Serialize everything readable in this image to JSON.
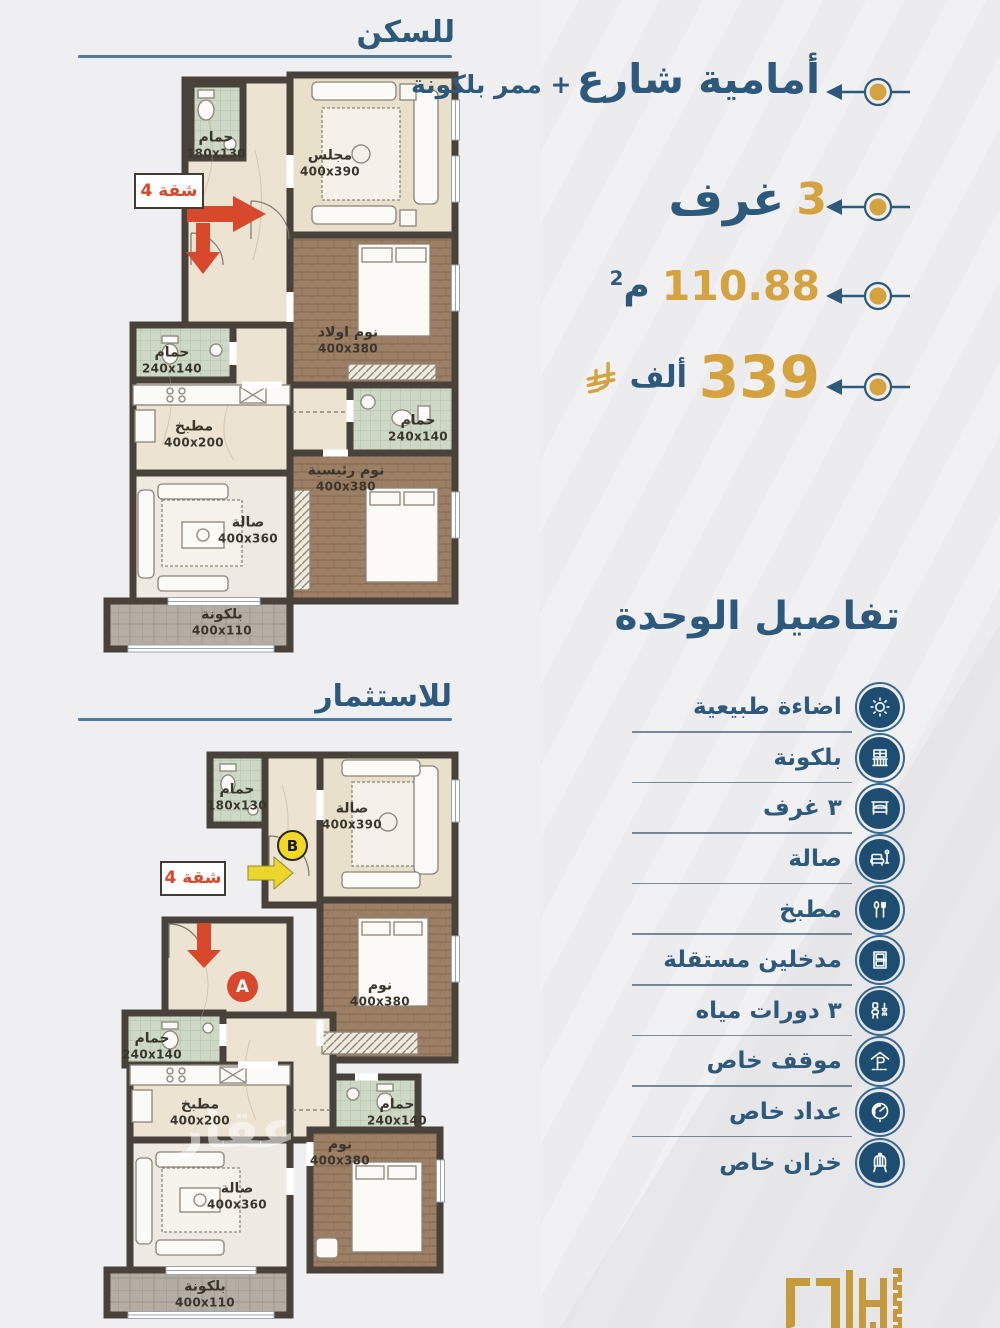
{
  "plans": {
    "residence": {
      "title": "للسكن",
      "badge": "شقة 4",
      "rooms": {
        "bath1": {
          "name": "حمام",
          "dims": "180x130"
        },
        "majlis": {
          "name": "مجلس",
          "dims": "400x390"
        },
        "kids_bedroom": {
          "name": "نوم اولاد",
          "dims": "400x380"
        },
        "bath2": {
          "name": "حمام",
          "dims": "240x140"
        },
        "kitchen": {
          "name": "مطبخ",
          "dims": "400x200"
        },
        "bath3": {
          "name": "حمام",
          "dims": "240x140"
        },
        "master_bedroom": {
          "name": "نوم رئيسية",
          "dims": "400x380"
        },
        "hall": {
          "name": "صالة",
          "dims": "400x360"
        },
        "balcony": {
          "name": "بلكونة",
          "dims": "400x110"
        }
      }
    },
    "investment": {
      "title": "للاستثمار",
      "badge": "شقة 4",
      "unit_a": "A",
      "unit_b": "B",
      "watermark": "عقار",
      "rooms": {
        "bath1": {
          "name": "حمام",
          "dims": "180x130"
        },
        "hall_top": {
          "name": "صالة",
          "dims": "400x390"
        },
        "bedroom_right": {
          "name": "نوم",
          "dims": "400x380"
        },
        "bath2": {
          "name": "حمام",
          "dims": "240x140"
        },
        "kitchen": {
          "name": "مطبخ",
          "dims": "400x200"
        },
        "bath3": {
          "name": "حمام",
          "dims": "240x140"
        },
        "bedroom_bottom": {
          "name": "نوم",
          "dims": "400x380"
        },
        "hall_bottom": {
          "name": "صالة",
          "dims": "400x360"
        },
        "balcony": {
          "name": "بلكونة",
          "dims": "400x110"
        }
      }
    }
  },
  "specs": {
    "frontage": {
      "line1": "أمامية شارع",
      "line2": "+ ممر بلكونة"
    },
    "rooms": {
      "value": "3",
      "label": "غرف"
    },
    "area": {
      "value": "110.88",
      "unit": "م",
      "sup": "2"
    },
    "price": {
      "value": "339",
      "label": "ألف",
      "currency_icon": "saudi-riyal-icon"
    }
  },
  "details": {
    "title": "تفاصيل الوحدة",
    "features": [
      {
        "label": "اضاءة طبيعية",
        "icon": "sun-icon"
      },
      {
        "label": "بلكونة",
        "icon": "balcony-icon"
      },
      {
        "label": "٣ غرف",
        "icon": "bedroom-icon"
      },
      {
        "label": "صالة",
        "icon": "sofa-icon"
      },
      {
        "label": "مطبخ",
        "icon": "kitchen-icon"
      },
      {
        "label": "مدخلين مستقلة",
        "icon": "entrance-icon"
      },
      {
        "label": "٣ دورات مياه",
        "icon": "bathroom-icon"
      },
      {
        "label": "موقف خاص",
        "icon": "parking-icon"
      },
      {
        "label": "عداد خاص",
        "icon": "meter-icon"
      },
      {
        "label": "خزان خاص",
        "icon": "tank-icon"
      }
    ]
  },
  "colors": {
    "navy": "#2d5a7c",
    "gold": "#d4a23e",
    "red": "#d8492c",
    "wall": "#48423a"
  }
}
